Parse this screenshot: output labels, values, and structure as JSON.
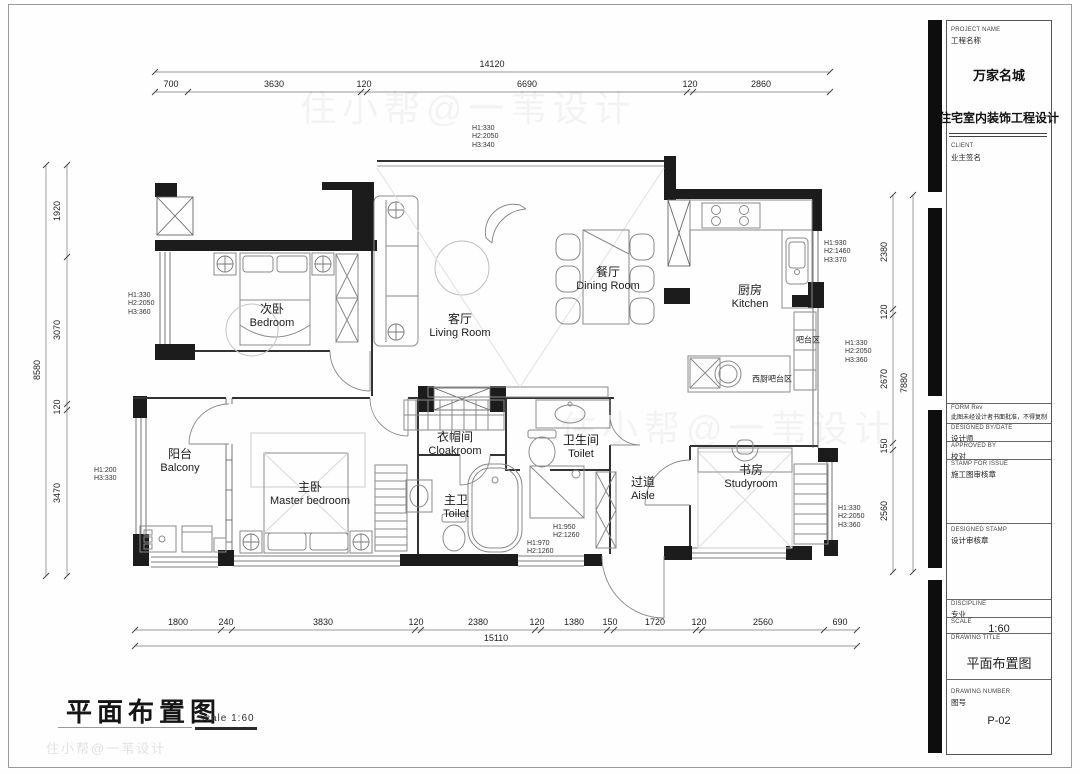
{
  "colors": {
    "wall": "#1c1c1c",
    "line": "#555555",
    "furniture": "#8a8a8a",
    "paper": "#ffffff"
  },
  "sheet": {
    "main_title": "平面布置图",
    "scale_note": "scale 1:60",
    "watermark": "住小帮@一苇设计"
  },
  "title_block": {
    "project_name_label": "PROJECT NAME",
    "project_name_label_zh": "工程名称",
    "project_name": "万家名城",
    "project_type": "住宅室内装饰工程设计",
    "client_label": "CLIENT",
    "client_value": "业主签名",
    "form_label": "FORM Rev",
    "form_note": "此图未经设计者书面批准，不得复制",
    "designed_by_label": "DESIGNED BY/DATE",
    "designed_by_value": "设计师",
    "approved_by_label": "APPROVED BY",
    "approved_by_value": "校对",
    "stamp_label": "STAMP FOR ISSUE",
    "stamp_value": "施工图审核章",
    "designed_stamp_label": "DESIGNED STAMP",
    "designed_stamp_value": "设计审核章",
    "discipline_label": "DISCIPLINE",
    "discipline_value": "专业",
    "scale_label": "SCALE",
    "scale_value": "1:60",
    "drawing_title_label": "DRAWING TITLE",
    "drawing_title_value": "平面布置图",
    "drawing_number_label": "DRAWING NUMBER",
    "drawing_number_zh": "图号",
    "drawing_number_value": "P-02"
  },
  "rooms": {
    "bedroom2": {
      "zh": "次卧",
      "en": "Bedroom"
    },
    "living": {
      "zh": "客厅",
      "en": "Living Room"
    },
    "dining": {
      "zh": "餐厅",
      "en": "Dining Room"
    },
    "kitchen": {
      "zh": "厨房",
      "en": "Kitchen"
    },
    "bar": {
      "zh": "吧台区"
    },
    "west_bar": {
      "zh": "西厨吧台区"
    },
    "cloakroom": {
      "zh": "衣帽间",
      "en": "Cloakroom"
    },
    "toilet": {
      "zh": "卫生间",
      "en": "Toilet"
    },
    "master_toilet": {
      "zh": "主卫",
      "en": "Toilet"
    },
    "aisle": {
      "zh": "过道",
      "en": "Aisle"
    },
    "balcony": {
      "zh": "阳台",
      "en": "Balcony"
    },
    "master_bedroom": {
      "zh": "主卧",
      "en": "Master bedroom"
    },
    "study": {
      "zh": "书房",
      "en": "Studyroom"
    }
  },
  "notes": {
    "living_top": [
      "H1:330",
      "H2:2050",
      "H3:340"
    ],
    "bedroom2_left": [
      "H1:330",
      "H2:2050",
      "H3:360"
    ],
    "balcony_left": [
      "H1:200",
      "H3:330"
    ],
    "kitchen_right": [
      "H1:930",
      "H2:1460",
      "H3:370"
    ],
    "bar_right": [
      "H1:330",
      "H2:2050",
      "H3:360"
    ],
    "study_right": [
      "H1:330",
      "H2:2050",
      "H3:360"
    ],
    "bath_note_1": [
      "H1:950",
      "H2:1260"
    ],
    "bath_note_2": [
      "H1:970",
      "H2:1260"
    ]
  },
  "dimensions": {
    "top": {
      "total": "14120",
      "segments": [
        "700",
        "3630",
        "120",
        "6690",
        "120",
        "2860"
      ]
    },
    "bottom": {
      "total": "15110",
      "segments": [
        "1800",
        "240",
        "3830",
        "120",
        "2380",
        "120",
        "1380",
        "150",
        "1720",
        "120",
        "2560",
        "690"
      ]
    },
    "left": {
      "total": "8580",
      "segments": [
        "1920",
        "3070",
        "120",
        "3470"
      ]
    },
    "right": {
      "total": "7880",
      "segments": [
        "2380",
        "120",
        "2670",
        "150",
        "2560"
      ]
    }
  }
}
